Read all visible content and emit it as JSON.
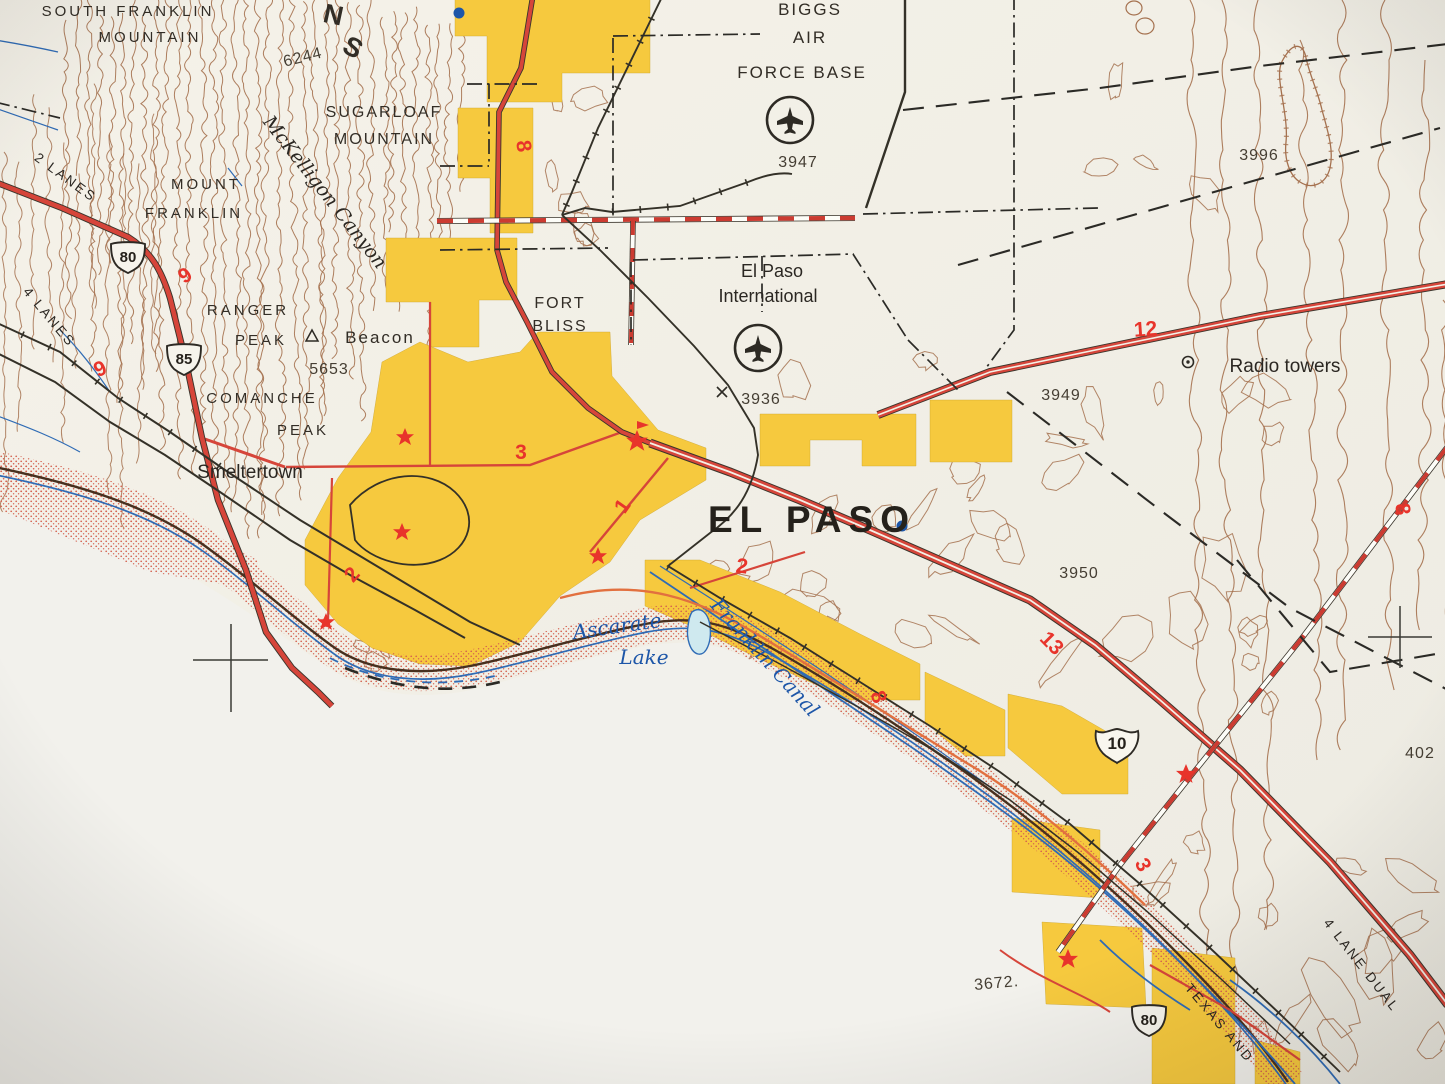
{
  "colors": {
    "paper": "#f3f0e7",
    "blank_paper": "#f2f1ec",
    "urban_tint": "#f6c93e",
    "road_red": "#d6453a",
    "route_number_red": "#e8342b",
    "contour_brown": "#a5714f",
    "water_blue": "#2f6bb5",
    "water_fill": "#cfe9ef",
    "ink_black": "#2d2a24",
    "stipple_red": "#d4604e"
  },
  "mountains": {
    "south_franklin": [
      "SOUTH FRANKLIN",
      "MOUNTAIN"
    ],
    "range_letters": [
      "N",
      "S"
    ],
    "sugarloaf": [
      "SUGARLOAF",
      "MOUNTAIN"
    ],
    "mount_franklin": [
      "MOUNT",
      "FRANKLIN"
    ],
    "ranger_peak": [
      "RANGER",
      "PEAK"
    ],
    "comanche_peak": [
      "COMANCHE",
      "PEAK"
    ],
    "mckelligon_canyon": "McKelligon Canyon"
  },
  "places": {
    "el_paso_city": "EL PASO",
    "smeltertown": "Smeltertown",
    "fort_bliss": [
      "FORT",
      "BLISS"
    ],
    "biggs_afb": [
      "BIGGS",
      "AIR",
      "FORCE BASE"
    ],
    "el_paso_international": [
      "El Paso",
      "International"
    ],
    "radio_towers": "Radio towers",
    "beacon": "Beacon"
  },
  "water": {
    "ascarate_lake": [
      "Ascarate",
      "Lake"
    ],
    "franklin_canal": "Franklin Canal"
  },
  "elevations": {
    "peak_6244": "6244",
    "ranger_5653": "5653",
    "biggs_3947": "3947",
    "spot_3996": "3996",
    "airport_3936": "3936",
    "spot_3949": "3949",
    "spot_3950": "3950",
    "spot_3672": "3672.",
    "spot_402x": "402"
  },
  "route_shields": {
    "us80_north": "80",
    "us85": "85",
    "interstate10": "10",
    "us80_south": "80"
  },
  "road_annotations": {
    "two_lanes": "2 LANES",
    "four_lanes": "4 LANES",
    "four_lane_dual": "4 LANE DUAL",
    "texas_and_railroad": "TEXAS AND"
  },
  "highway_numbers": {
    "n9_west": "9",
    "n9_valley": "9",
    "n8_north": "8",
    "n8_east": "8",
    "n8_canal": "8",
    "n12": "12",
    "n13": "13",
    "n1": "1",
    "n2_west": "2",
    "n2_center": "2",
    "n3_center": "3",
    "n3_southeast": "3"
  },
  "symbols": {
    "airport_symbol": "airplane-in-circle",
    "radio_tower_symbol": "circled-dot",
    "interchange_star": "red-star",
    "beacon_symbol": "triangle",
    "city_center_dot": "blue-dot",
    "elevation_x": "x-mark",
    "grid_tick": "crosshair"
  }
}
